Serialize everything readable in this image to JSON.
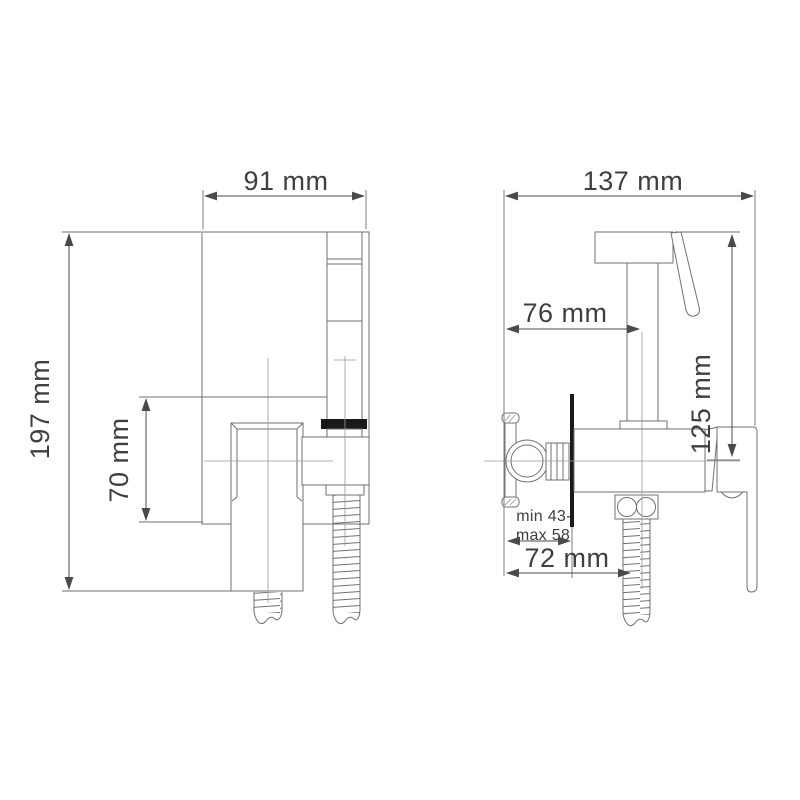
{
  "colors": {
    "background": "#ffffff",
    "line": "#717171",
    "dimension_ink": "#3f3f3f",
    "solid_ink": "#1a1a1a"
  },
  "front_view": {
    "width_label": "91 mm",
    "height_label": "197 mm",
    "valve_height_label": "70 mm"
  },
  "side_view": {
    "depth_label": "137 mm",
    "spout_offset_label": "76 mm",
    "spout_height_label": "125 mm",
    "wall_thickness_label_line1": "min 43-",
    "wall_thickness_label_line2": "max 58",
    "hose_offset_label": "72 mm"
  }
}
